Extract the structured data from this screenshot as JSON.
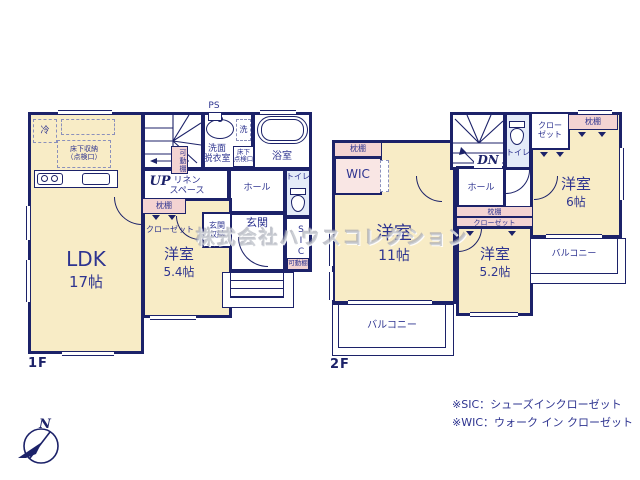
{
  "colors": {
    "wall": "#1c2269",
    "text": "#2e3490",
    "room": "#f8ecc6",
    "closet": "#f3d3d2",
    "closet_light": "#f9e6e4",
    "wet": "#e4ebf8"
  },
  "watermark": "株式会社ハウスコレクション",
  "compass": {
    "north": "N"
  },
  "f1": {
    "floor": "1F",
    "ps": "PS",
    "up": "UP",
    "ldk": "LDK",
    "ldk_size": "17帖",
    "bed": "洋室",
    "bed_size": "5.4帖",
    "entrance": "玄関",
    "entrance_storage": [
      "玄関",
      "収納"
    ],
    "hall": "ホール",
    "toilet": "トイレ",
    "bath": "浴室",
    "washroom": [
      "洗面",
      "脱衣室"
    ],
    "washer": "洗",
    "fridge": "冷",
    "underfloor": [
      "床下収納",
      "（点検口）"
    ],
    "hatch": [
      "床下",
      "点検口"
    ],
    "linen": [
      "リネン",
      "スペース"
    ],
    "shelf_stairs": "可動棚",
    "shelf_sic": "可動棚",
    "pillow": "枕棚",
    "closet": "クローゼット",
    "sic": "SIC"
  },
  "f2": {
    "floor": "2F",
    "dn": "DN",
    "bed11": "洋室",
    "bed11_size": "11帖",
    "bed52": "洋室",
    "bed52_size": "5.2帖",
    "bed6": "洋室",
    "bed6_size": "6帖",
    "wic": "WIC",
    "wic_pillow": "枕棚",
    "hall": "ホール",
    "toilet": "トイレ",
    "closet6": [
      "クロー",
      "ゼット"
    ],
    "pillow6": "枕棚",
    "pillow52": "枕棚",
    "closet52": "クローゼット",
    "balcony_s": "バルコニー",
    "balcony_e": "バルコニー"
  },
  "legend": [
    "※SIC：シューズインクローゼット",
    "※WIC：ウォーク イン クローゼット"
  ]
}
